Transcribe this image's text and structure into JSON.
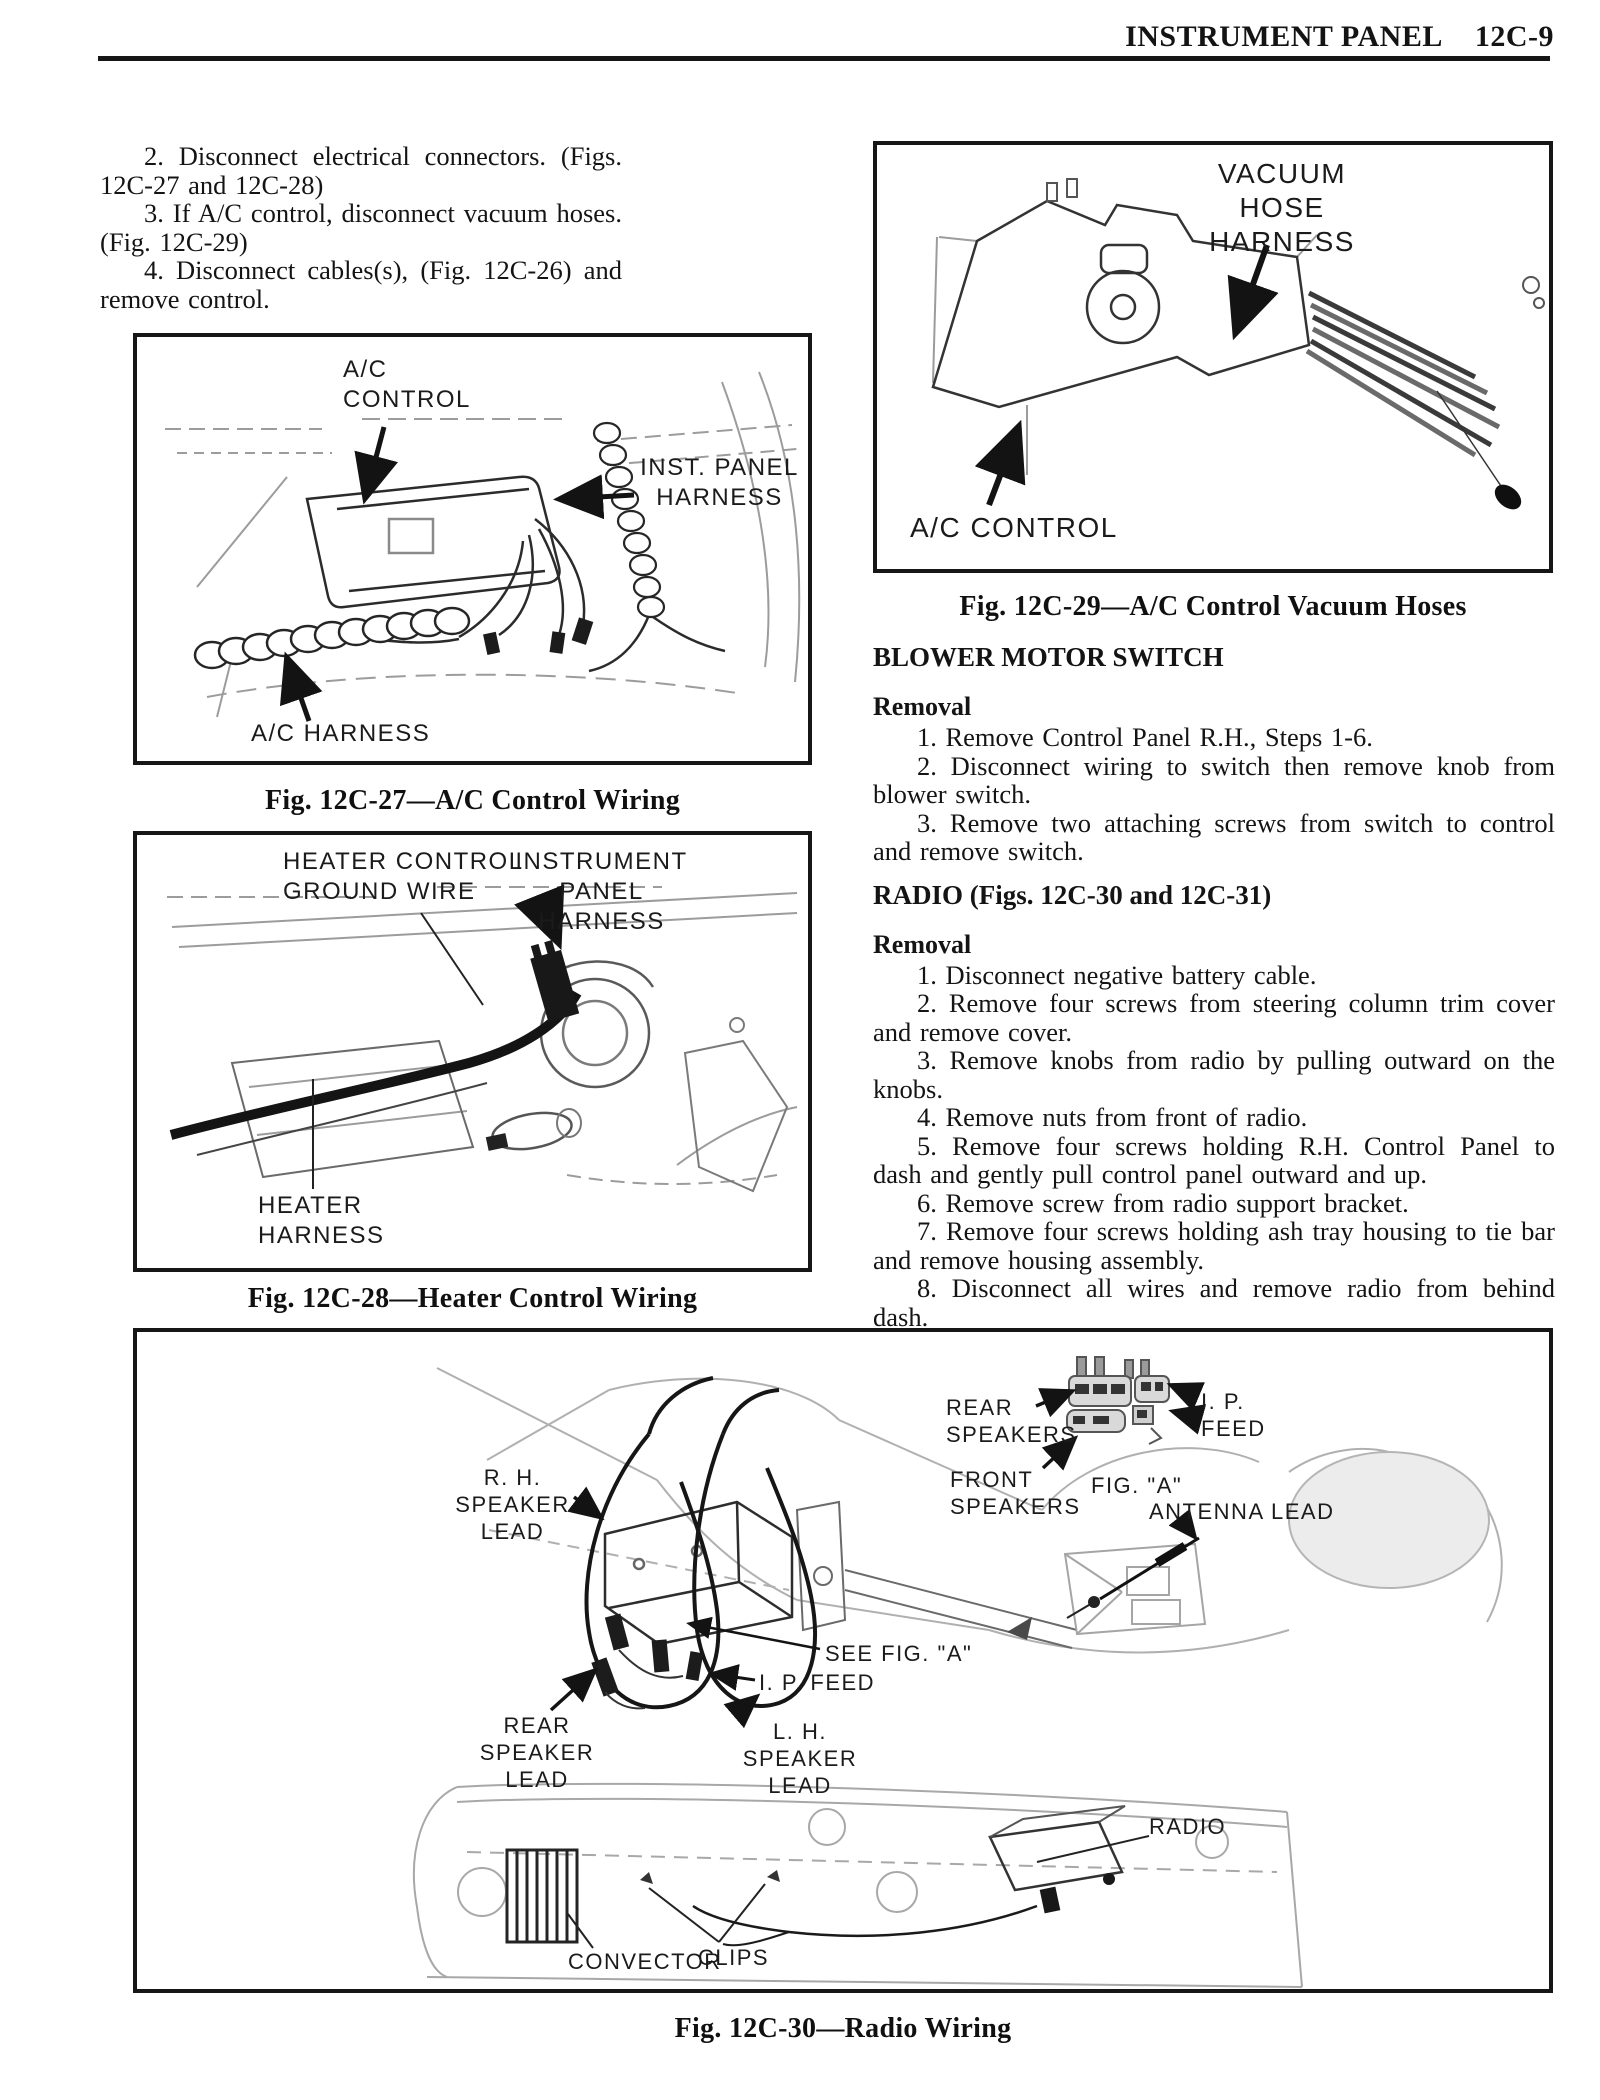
{
  "header": {
    "title": "INSTRUMENT PANEL",
    "page_number": "12C-9"
  },
  "intro": {
    "steps": [
      "2. Disconnect electrical connectors. (Figs. 12C-27 and 12C-28)",
      "3. If A/C control, disconnect vacuum hoses. (Fig. 12C-29)",
      "4. Disconnect cables(s), (Fig. 12C-26) and remove control."
    ]
  },
  "fig27": {
    "caption": "Fig. 12C-27—A/C Control Wiring",
    "labels": {
      "ac_control": "A/C\nCONTROL",
      "inst_panel_harness": "INST. PANEL\nHARNESS",
      "ac_harness": "A/C HARNESS"
    }
  },
  "fig28": {
    "caption": "Fig. 12C-28—Heater Control Wiring",
    "labels": {
      "heater_control_ground_wire": "HEATER CONTROL\nGROUND WIRE",
      "instrument_panel_harness": "INSTRUMENT\nPANEL HARNESS",
      "heater_harness": "HEATER\nHARNESS"
    }
  },
  "fig29": {
    "caption": "Fig. 12C-29—A/C Control Vacuum Hoses",
    "labels": {
      "vacuum_hose_harness": "VACUUM HOSE\nHARNESS",
      "ac_control": "A/C CONTROL"
    }
  },
  "blower": {
    "heading": "BLOWER MOTOR SWITCH",
    "removal_label": "Removal",
    "steps": [
      "1. Remove Control Panel R.H., Steps 1-6.",
      "2. Disconnect wiring to switch then remove knob from blower switch.",
      "3. Remove two attaching screws from switch to control and remove switch."
    ]
  },
  "radio": {
    "heading": "RADIO (Figs. 12C-30 and 12C-31)",
    "removal_label": "Removal",
    "steps": [
      "1. Disconnect negative battery cable.",
      "2. Remove four screws from steering column trim cover and remove cover.",
      "3. Remove knobs from radio by pulling outward on the knobs.",
      "4. Remove nuts from front of radio.",
      "5. Remove four screws holding R.H. Control Panel to dash and gently pull control panel outward and up.",
      "6. Remove screw from radio support bracket.",
      "7. Remove four screws holding ash tray housing to tie bar and remove housing assembly.",
      "8. Disconnect all wires and remove radio from behind dash."
    ]
  },
  "fig30": {
    "caption": "Fig. 12C-30—Radio Wiring",
    "labels": {
      "rear_speakers": "REAR\nSPEAKERS",
      "ip_feed_top": "I. P.\nFEED",
      "front_speakers": "FRONT\nSPEAKERS",
      "fig_a": "FIG. \"A\"",
      "antenna_lead": "ANTENNA LEAD",
      "rh_speaker_lead": "R. H.  SPEAKER\nLEAD",
      "see_fig_a": "SEE FIG.  \"A\"",
      "ip_feed": "I. P.  FEED",
      "rear_speaker_lead": "REAR SPEAKER\nLEAD",
      "lh_speaker_lead": "L. H.  SPEAKER\nLEAD",
      "radio": "RADIO",
      "convector": "CONVECTOR",
      "clips": "CLIPS"
    }
  }
}
